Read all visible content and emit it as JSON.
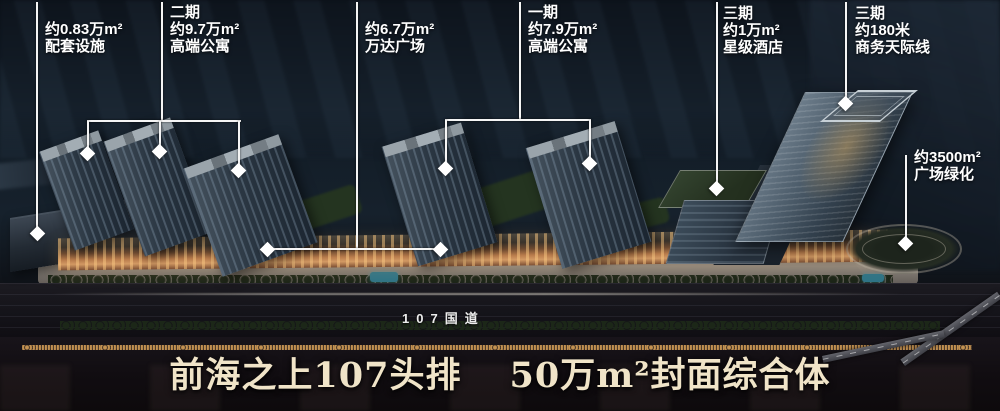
{
  "callouts": [
    {
      "id": "annex",
      "lines": [
        "约0.83万m²",
        "配套设施"
      ]
    },
    {
      "id": "phase2-apartments",
      "lines": [
        "二期",
        "约9.7万m²",
        "高端公寓"
      ]
    },
    {
      "id": "wanda-plaza",
      "lines": [
        "约6.7万m²",
        "万达广场"
      ]
    },
    {
      "id": "phase1-apartments",
      "lines": [
        "一期",
        "约7.9万m²",
        "高端公寓"
      ]
    },
    {
      "id": "phase3-hotel",
      "lines": [
        "三期",
        "约1万m²",
        "星级酒店"
      ]
    },
    {
      "id": "phase3-skyline",
      "lines": [
        "三期",
        "约180米",
        "商务天际线"
      ]
    },
    {
      "id": "plaza-green",
      "lines": [
        "约3500m²",
        "广场绿化"
      ]
    }
  ],
  "road": {
    "label": "107国道"
  },
  "headline": {
    "left": "前海之上107头排",
    "right": "50万m²封面综合体"
  },
  "colors": {
    "label_text": "#ffffff",
    "callout_line": "#f5f5f5",
    "headline_text": "#f0e4c8",
    "road_label_text": "#ececec",
    "podium_glow": "#d39a64",
    "tower_facade": "#2a3642",
    "sky_top": "#0a0f16"
  }
}
